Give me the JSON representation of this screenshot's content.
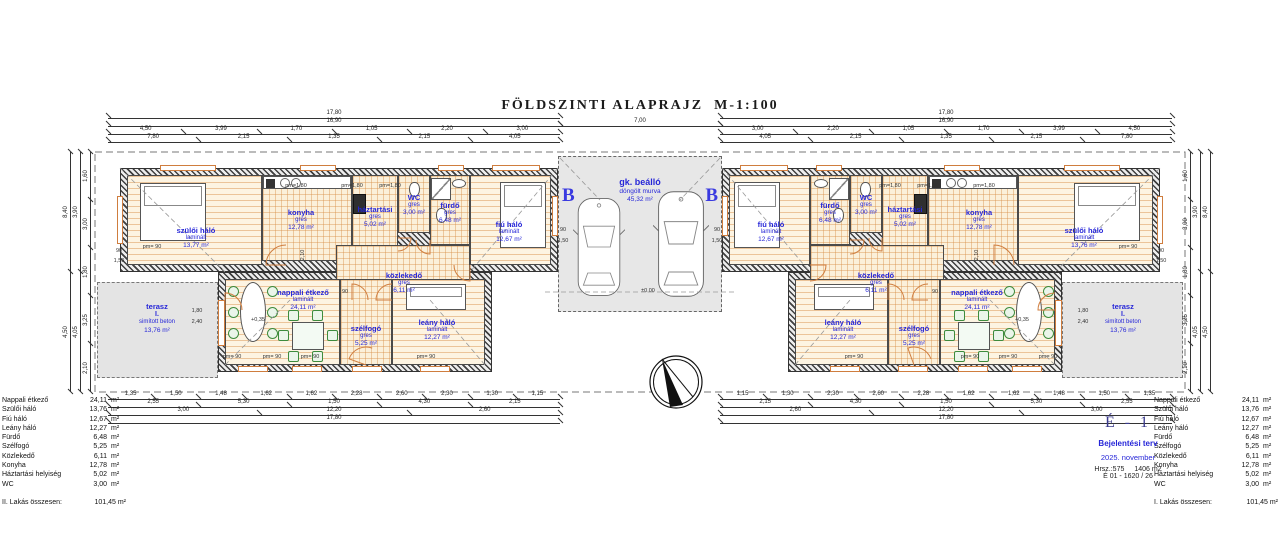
{
  "title": "FÖLDSZINTI ALAPRAJZ  M-1:100",
  "colors": {
    "label_blue": "#2626d8",
    "wall": "#3f3f3f",
    "floor_line": "#d68a40",
    "opening_orange": "#cf7d3e",
    "gray_fill": "#e4e4e4"
  },
  "carport": {
    "name": "gk. beálló",
    "finish": "döngölt murva",
    "area": "45,32 m²",
    "section_marker": "B",
    "level": "±0,00"
  },
  "rooms": [
    {
      "n": "szülői háló",
      "f": "laminált",
      "a": "13,77 m²",
      "x": 127,
      "y": 175,
      "w": 135,
      "h": 90,
      "lx": 196,
      "ly": 238,
      "k": "wood"
    },
    {
      "n": "konyha",
      "f": "gres",
      "a": "12,78 m²",
      "x": 262,
      "y": 175,
      "w": 90,
      "h": 86,
      "lx": 301,
      "ly": 220,
      "k": "tile"
    },
    {
      "n": "háztartási",
      "f": "gres",
      "a": "5,02 m²",
      "x": 352,
      "y": 175,
      "w": 46,
      "h": 86,
      "lx": 375,
      "ly": 217,
      "k": "tile"
    },
    {
      "n": "WC",
      "f": "gres",
      "a": "3,00 m²",
      "x": 398,
      "y": 175,
      "w": 32,
      "h": 58,
      "lx": 414,
      "ly": 205,
      "k": "tile"
    },
    {
      "n": "fürdő",
      "f": "gres",
      "a": "6,48 m²",
      "x": 430,
      "y": 175,
      "w": 40,
      "h": 70,
      "lx": 450,
      "ly": 213,
      "k": "tile"
    },
    {
      "n": "fiú háló",
      "f": "laminált",
      "a": "12,67 m²",
      "x": 470,
      "y": 175,
      "w": 81,
      "h": 90,
      "lx": 509,
      "ly": 232,
      "k": "wood"
    },
    {
      "n": "közlekedő",
      "f": "gres",
      "a": "6,11 m²",
      "x": 336,
      "y": 245,
      "w": 134,
      "h": 55,
      "lx": 404,
      "ly": 283,
      "k": "tile"
    },
    {
      "n": "nappali étkező",
      "f": "laminált",
      "a": "24,11 m²",
      "x": 225,
      "y": 279,
      "w": 115,
      "h": 86,
      "lx": 303,
      "ly": 300,
      "k": "wood"
    },
    {
      "n": "szélfogó",
      "f": "gres",
      "a": "5,25 m²",
      "x": 340,
      "y": 279,
      "w": 52,
      "h": 86,
      "lx": 366,
      "ly": 336,
      "k": "tile"
    },
    {
      "n": "leány háló",
      "f": "laminált",
      "a": "12,27 m²",
      "x": 392,
      "y": 279,
      "w": 93,
      "h": 86,
      "lx": 437,
      "ly": 330,
      "k": "wood"
    },
    {
      "n": "terasz",
      "l2": "I.",
      "f": "simított beton",
      "a": "13,76 m²",
      "x": 97,
      "y": 282,
      "w": 121,
      "h": 96,
      "lx": 157,
      "ly": 318,
      "k": "gray"
    },
    {
      "n": "fiú háló",
      "f": "laminált",
      "a": "12,67 m²",
      "x": 729,
      "y": 175,
      "w": 81,
      "h": 90,
      "lx": 771,
      "ly": 232,
      "k": "wood"
    },
    {
      "n": "fürdő",
      "f": "gres",
      "a": "6,48 m²",
      "x": 810,
      "y": 175,
      "w": 40,
      "h": 70,
      "lx": 830,
      "ly": 213,
      "k": "tile"
    },
    {
      "n": "WC",
      "f": "gres",
      "a": "3,00 m²",
      "x": 850,
      "y": 175,
      "w": 32,
      "h": 58,
      "lx": 866,
      "ly": 205,
      "k": "tile"
    },
    {
      "n": "háztartási",
      "f": "gres",
      "a": "5,02 m²",
      "x": 882,
      "y": 175,
      "w": 46,
      "h": 86,
      "lx": 905,
      "ly": 217,
      "k": "tile"
    },
    {
      "n": "konyha",
      "f": "gres",
      "a": "12,78 m²",
      "x": 928,
      "y": 175,
      "w": 90,
      "h": 86,
      "lx": 979,
      "ly": 220,
      "k": "tile"
    },
    {
      "n": "szülői háló",
      "f": "laminált",
      "a": "13,76 m²",
      "x": 1018,
      "y": 175,
      "w": 135,
      "h": 90,
      "lx": 1084,
      "ly": 238,
      "k": "wood"
    },
    {
      "n": "közlekedő",
      "f": "gres",
      "a": "6,11 m²",
      "x": 810,
      "y": 245,
      "w": 134,
      "h": 55,
      "lx": 876,
      "ly": 283,
      "k": "tile"
    },
    {
      "n": "nappali étkező",
      "f": "laminált",
      "a": "24,11 m²",
      "x": 940,
      "y": 279,
      "w": 115,
      "h": 86,
      "lx": 977,
      "ly": 300,
      "k": "wood"
    },
    {
      "n": "szélfogó",
      "f": "gres",
      "a": "5,25 m²",
      "x": 888,
      "y": 279,
      "w": 52,
      "h": 86,
      "lx": 914,
      "ly": 336,
      "k": "tile"
    },
    {
      "n": "leány háló",
      "f": "laminált",
      "a": "12,27 m²",
      "x": 795,
      "y": 279,
      "w": 93,
      "h": 86,
      "lx": 843,
      "ly": 330,
      "k": "wood"
    },
    {
      "n": "terasz",
      "l2": "I.",
      "f": "simított beton",
      "a": "13,76 m²",
      "x": 1062,
      "y": 282,
      "w": 121,
      "h": 96,
      "lx": 1123,
      "ly": 318,
      "k": "gray"
    }
  ],
  "walls": [
    {
      "x": 120,
      "y": 168,
      "w": 438,
      "h": 104
    },
    {
      "x": 218,
      "y": 272,
      "w": 274,
      "h": 100
    },
    {
      "x": 722,
      "y": 168,
      "w": 438,
      "h": 104
    },
    {
      "x": 788,
      "y": 272,
      "w": 274,
      "h": 100
    }
  ],
  "site": {
    "x": 95,
    "y": 152,
    "w": 1090,
    "h": 240
  },
  "dims": [
    {
      "x": 108,
      "y": 118,
      "len": 452,
      "dir": "h",
      "v": [
        "17,80"
      ]
    },
    {
      "x": 108,
      "y": 126,
      "len": 452,
      "dir": "h",
      "v": [
        "16,90"
      ]
    },
    {
      "x": 108,
      "y": 134,
      "len": 452,
      "dir": "h",
      "v": [
        "4,50",
        "3,99",
        "1,70",
        "1,05",
        "2,20",
        "3,00"
      ]
    },
    {
      "x": 108,
      "y": 142,
      "len": 452,
      "dir": "h",
      "v": [
        "7,80",
        "2,15",
        "1,35",
        "2,15",
        "4,05"
      ]
    },
    {
      "x": 560,
      "y": 126,
      "len": 160,
      "dir": "h",
      "v": [
        "7,00"
      ]
    },
    {
      "x": 720,
      "y": 118,
      "len": 452,
      "dir": "h",
      "v": [
        "17,80"
      ]
    },
    {
      "x": 720,
      "y": 126,
      "len": 452,
      "dir": "h",
      "v": [
        "16,90"
      ]
    },
    {
      "x": 720,
      "y": 134,
      "len": 452,
      "dir": "h",
      "v": [
        "3,00",
        "2,20",
        "1,05",
        "1,70",
        "3,99",
        "4,50"
      ]
    },
    {
      "x": 720,
      "y": 142,
      "len": 452,
      "dir": "h",
      "v": [
        "4,05",
        "2,15",
        "1,35",
        "2,15",
        "7,80"
      ]
    },
    {
      "x": 108,
      "y": 399,
      "len": 452,
      "dir": "h",
      "v": [
        "1,35",
        "1,50",
        "1,48",
        "1,62",
        "1,62",
        "2,28",
        "2,60",
        "2,30",
        "1,30",
        "1,15"
      ]
    },
    {
      "x": 108,
      "y": 407,
      "len": 452,
      "dir": "h",
      "v": [
        "2,55",
        "5,30",
        "1,50",
        "4,30",
        "2,15"
      ]
    },
    {
      "x": 108,
      "y": 415,
      "len": 452,
      "dir": "h",
      "v": [
        "3,00",
        "12,20",
        "2,60"
      ]
    },
    {
      "x": 108,
      "y": 423,
      "len": 452,
      "dir": "h",
      "v": [
        "17,80"
      ]
    },
    {
      "x": 720,
      "y": 399,
      "len": 452,
      "dir": "h",
      "v": [
        "1,15",
        "1,30",
        "2,30",
        "2,60",
        "2,28",
        "1,62",
        "1,62",
        "1,48",
        "1,50",
        "1,35"
      ]
    },
    {
      "x": 720,
      "y": 407,
      "len": 452,
      "dir": "h",
      "v": [
        "2,15",
        "4,30",
        "1,50",
        "5,30",
        "2,55"
      ]
    },
    {
      "x": 720,
      "y": 415,
      "len": 452,
      "dir": "h",
      "v": [
        "2,60",
        "12,20",
        "3,00"
      ]
    },
    {
      "x": 720,
      "y": 423,
      "len": 452,
      "dir": "h",
      "v": [
        "17,80"
      ]
    },
    {
      "x": 70,
      "y": 152,
      "len": 240,
      "dir": "v",
      "v": [
        "8,40",
        "4,50"
      ]
    },
    {
      "x": 80,
      "y": 152,
      "len": 240,
      "dir": "v",
      "v": [
        "3,90",
        "4,05"
      ]
    },
    {
      "x": 90,
      "y": 152,
      "len": 240,
      "dir": "v",
      "v": [
        "1,60",
        "3,00",
        "1,80",
        "3,25",
        "2,10"
      ]
    },
    {
      "x": 1210,
      "y": 152,
      "len": 240,
      "dir": "v",
      "v": [
        "8,40",
        "4,50"
      ]
    },
    {
      "x": 1200,
      "y": 152,
      "len": 240,
      "dir": "v",
      "v": [
        "3,90",
        "4,05"
      ]
    },
    {
      "x": 1190,
      "y": 152,
      "len": 240,
      "dir": "v",
      "v": [
        "1,60",
        "3,00",
        "1,80",
        "3,25",
        "2,10"
      ]
    }
  ],
  "annotations": [
    {
      "t": "pm=1,80",
      "x": 296,
      "y": 186
    },
    {
      "t": "pm=1,80",
      "x": 352,
      "y": 186
    },
    {
      "t": "pm=1,80",
      "x": 390,
      "y": 186
    },
    {
      "t": "pm=1,80",
      "x": 890,
      "y": 186
    },
    {
      "t": "pm=1,80",
      "x": 928,
      "y": 186
    },
    {
      "t": "pm=1,80",
      "x": 984,
      "y": 186
    },
    {
      "t": "pm= 90",
      "x": 232,
      "y": 357
    },
    {
      "t": "pm= 90",
      "x": 272,
      "y": 357
    },
    {
      "t": "pm= 90",
      "x": 310,
      "y": 357
    },
    {
      "t": "pm= 90",
      "x": 426,
      "y": 357
    },
    {
      "t": "pm= 90",
      "x": 1048,
      "y": 357
    },
    {
      "t": "pm= 90",
      "x": 1008,
      "y": 357
    },
    {
      "t": "pm= 90",
      "x": 970,
      "y": 357
    },
    {
      "t": "pm= 90",
      "x": 854,
      "y": 357
    },
    {
      "t": "pm= 90",
      "x": 152,
      "y": 247
    },
    {
      "t": "pm= 90",
      "x": 1128,
      "y": 247
    },
    {
      "t": "1,80",
      "x": 197,
      "y": 311
    },
    {
      "t": "2,40",
      "x": 197,
      "y": 322
    },
    {
      "t": "1,80",
      "x": 1083,
      "y": 311
    },
    {
      "t": "2,40",
      "x": 1083,
      "y": 322
    },
    {
      "t": "90",
      "x": 119,
      "y": 251
    },
    {
      "t": "1,50",
      "x": 119,
      "y": 261
    },
    {
      "t": "90",
      "x": 1161,
      "y": 251
    },
    {
      "t": "1,50",
      "x": 1161,
      "y": 261
    },
    {
      "t": "90",
      "x": 563,
      "y": 230
    },
    {
      "t": "1,50",
      "x": 563,
      "y": 241
    },
    {
      "t": "90",
      "x": 717,
      "y": 230
    },
    {
      "t": "1,50",
      "x": 717,
      "y": 241
    },
    {
      "t": "+0,35",
      "x": 258,
      "y": 320
    },
    {
      "t": "+0,35",
      "x": 1022,
      "y": 320
    },
    {
      "t": "±0,00",
      "x": 648,
      "y": 291
    },
    {
      "t": "2,10",
      "x": 303,
      "y": 255,
      "r": -90
    },
    {
      "t": "2,10",
      "x": 977,
      "y": 255,
      "r": -90
    },
    {
      "t": "90",
      "x": 345,
      "y": 292
    },
    {
      "t": "90",
      "x": 935,
      "y": 292
    }
  ],
  "openings": [
    {
      "x": 160,
      "y": 165,
      "w": 56,
      "h": 6
    },
    {
      "x": 300,
      "y": 165,
      "w": 36,
      "h": 6
    },
    {
      "x": 438,
      "y": 165,
      "w": 26,
      "h": 6
    },
    {
      "x": 492,
      "y": 165,
      "w": 48,
      "h": 6
    },
    {
      "x": 117,
      "y": 196,
      "w": 6,
      "h": 48
    },
    {
      "x": 238,
      "y": 366,
      "w": 30,
      "h": 6
    },
    {
      "x": 292,
      "y": 366,
      "w": 30,
      "h": 6
    },
    {
      "x": 420,
      "y": 366,
      "w": 30,
      "h": 6
    },
    {
      "x": 352,
      "y": 366,
      "w": 30,
      "h": 6
    },
    {
      "x": 218,
      "y": 300,
      "w": 7,
      "h": 46
    },
    {
      "x": 552,
      "y": 196,
      "w": 6,
      "h": 40
    },
    {
      "x": 1064,
      "y": 165,
      "w": 56,
      "h": 6
    },
    {
      "x": 944,
      "y": 165,
      "w": 36,
      "h": 6
    },
    {
      "x": 816,
      "y": 165,
      "w": 26,
      "h": 6
    },
    {
      "x": 740,
      "y": 165,
      "w": 48,
      "h": 6
    },
    {
      "x": 1157,
      "y": 196,
      "w": 6,
      "h": 48
    },
    {
      "x": 1012,
      "y": 366,
      "w": 30,
      "h": 6
    },
    {
      "x": 958,
      "y": 366,
      "w": 30,
      "h": 6
    },
    {
      "x": 830,
      "y": 366,
      "w": 30,
      "h": 6
    },
    {
      "x": 898,
      "y": 366,
      "w": 30,
      "h": 6
    },
    {
      "x": 1055,
      "y": 300,
      "w": 7,
      "h": 46
    },
    {
      "x": 722,
      "y": 196,
      "w": 6,
      "h": 40
    }
  ],
  "arcs": [
    {
      "x": 286,
      "y": 265,
      "r": 20,
      "a0": 180,
      "a1": 270
    },
    {
      "x": 352,
      "y": 300,
      "r": 16,
      "a0": 270,
      "a1": 360
    },
    {
      "x": 392,
      "y": 300,
      "r": 16,
      "a0": 180,
      "a1": 270
    },
    {
      "x": 430,
      "y": 240,
      "r": 14,
      "a0": 90,
      "a1": 180
    },
    {
      "x": 398,
      "y": 238,
      "r": 13,
      "a0": 0,
      "a1": 90
    },
    {
      "x": 366,
      "y": 365,
      "r": 18,
      "a0": 200,
      "a1": 290
    },
    {
      "x": 225,
      "y": 310,
      "r": 17,
      "a0": 270,
      "a1": 360
    },
    {
      "x": 470,
      "y": 265,
      "r": 16,
      "a0": 90,
      "a1": 180
    },
    {
      "x": 994,
      "y": 265,
      "r": 20,
      "a0": 270,
      "a1": 360
    },
    {
      "x": 928,
      "y": 300,
      "r": 16,
      "a0": 180,
      "a1": 270
    },
    {
      "x": 888,
      "y": 300,
      "r": 16,
      "a0": 270,
      "a1": 360
    },
    {
      "x": 850,
      "y": 240,
      "r": 14,
      "a0": 0,
      "a1": 90
    },
    {
      "x": 882,
      "y": 238,
      "r": 13,
      "a0": 90,
      "a1": 180
    },
    {
      "x": 914,
      "y": 365,
      "r": 18,
      "a0": 250,
      "a1": 340
    },
    {
      "x": 1055,
      "y": 310,
      "r": 17,
      "a0": 180,
      "a1": 270
    },
    {
      "x": 810,
      "y": 265,
      "r": 16,
      "a0": 0,
      "a1": 90
    }
  ],
  "dash_lines": [
    {
      "x1": 120,
      "y1": 168,
      "x2": 225,
      "y2": 272
    },
    {
      "x1": 558,
      "y1": 168,
      "x2": 470,
      "y2": 272
    },
    {
      "x1": 225,
      "y1": 365,
      "x2": 290,
      "y2": 300
    },
    {
      "x1": 485,
      "y1": 365,
      "x2": 430,
      "y2": 300
    },
    {
      "x1": 1160,
      "y1": 168,
      "x2": 1055,
      "y2": 272
    },
    {
      "x1": 722,
      "y1": 168,
      "x2": 810,
      "y2": 272
    },
    {
      "x1": 1055,
      "y1": 365,
      "x2": 990,
      "y2": 300
    },
    {
      "x1": 795,
      "y1": 365,
      "x2": 850,
      "y2": 300
    },
    {
      "x1": 560,
      "y1": 158,
      "x2": 600,
      "y2": 200
    },
    {
      "x1": 720,
      "y1": 158,
      "x2": 680,
      "y2": 200
    },
    {
      "x1": 545,
      "y1": 292,
      "x2": 735,
      "y2": 292
    }
  ],
  "furniture": [
    {
      "t": "bed",
      "x": 140,
      "y": 183,
      "w": 66,
      "h": 58
    },
    {
      "t": "bed",
      "x": 500,
      "y": 182,
      "w": 46,
      "h": 66
    },
    {
      "t": "bed",
      "x": 406,
      "y": 284,
      "w": 60,
      "h": 26
    },
    {
      "t": "dining-round",
      "x": 228,
      "y": 280,
      "w": 48,
      "h": 62
    },
    {
      "t": "dining-sq",
      "x": 278,
      "y": 310,
      "w": 58,
      "h": 50
    },
    {
      "t": "counter",
      "x": 263,
      "y": 176,
      "w": 88,
      "h": 13
    },
    {
      "t": "appliance",
      "x": 353,
      "y": 194,
      "w": 13,
      "h": 20
    },
    {
      "t": "shower",
      "x": 431,
      "y": 178,
      "w": 20,
      "h": 22
    },
    {
      "t": "toilet",
      "x": 436,
      "y": 208,
      "w": 11,
      "h": 15
    },
    {
      "t": "sink",
      "x": 452,
      "y": 179,
      "w": 14,
      "h": 9
    },
    {
      "t": "toilet",
      "x": 409,
      "y": 182,
      "w": 11,
      "h": 15
    },
    {
      "t": "bed",
      "x": 1074,
      "y": 183,
      "w": 66,
      "h": 58
    },
    {
      "t": "bed",
      "x": 734,
      "y": 182,
      "w": 46,
      "h": 66
    },
    {
      "t": "bed",
      "x": 814,
      "y": 284,
      "w": 60,
      "h": 26
    },
    {
      "t": "dining-round",
      "x": 1004,
      "y": 280,
      "w": 48,
      "h": 62
    },
    {
      "t": "dining-sq",
      "x": 944,
      "y": 310,
      "w": 58,
      "h": 50
    },
    {
      "t": "counter",
      "x": 929,
      "y": 176,
      "w": 88,
      "h": 13
    },
    {
      "t": "appliance",
      "x": 914,
      "y": 194,
      "w": 13,
      "h": 20
    },
    {
      "t": "shower",
      "x": 829,
      "y": 178,
      "w": 20,
      "h": 22
    },
    {
      "t": "toilet",
      "x": 833,
      "y": 208,
      "w": 11,
      "h": 15
    },
    {
      "t": "sink",
      "x": 814,
      "y": 179,
      "w": 14,
      "h": 9
    },
    {
      "t": "toilet",
      "x": 860,
      "y": 182,
      "w": 11,
      "h": 15
    }
  ],
  "tables": {
    "unit": "m²",
    "rows": [
      {
        "label": "Nappali étkező",
        "value": "24,11"
      },
      {
        "label": "Szülői háló",
        "value": "13,76"
      },
      {
        "label": "Fiú háló",
        "value": "12,67"
      },
      {
        "label": "Leány háló",
        "value": "12,27"
      },
      {
        "label": "Fürdő",
        "value": "6,48"
      },
      {
        "label": "Szélfogó",
        "value": "5,25"
      },
      {
        "label": "Közlekedő",
        "value": "6,11"
      },
      {
        "label": "Konyha",
        "value": "12,78"
      },
      {
        "label": "Háztartási helyiség",
        "value": "5,02"
      },
      {
        "label": "WC",
        "value": "3,00"
      }
    ],
    "left_total_label": "II. Lakás összesen:",
    "right_total_label": "I. Lakás összesen:",
    "total_value": "101,45 m²"
  },
  "titleblock": {
    "sheet": "É - 1",
    "doc_type": "Bejelentési terv",
    "date": "2025. november",
    "parcel": "Hrsz.:575",
    "parcel_area": "1406 m2",
    "ref": "É 01 - 1620 / 26"
  }
}
